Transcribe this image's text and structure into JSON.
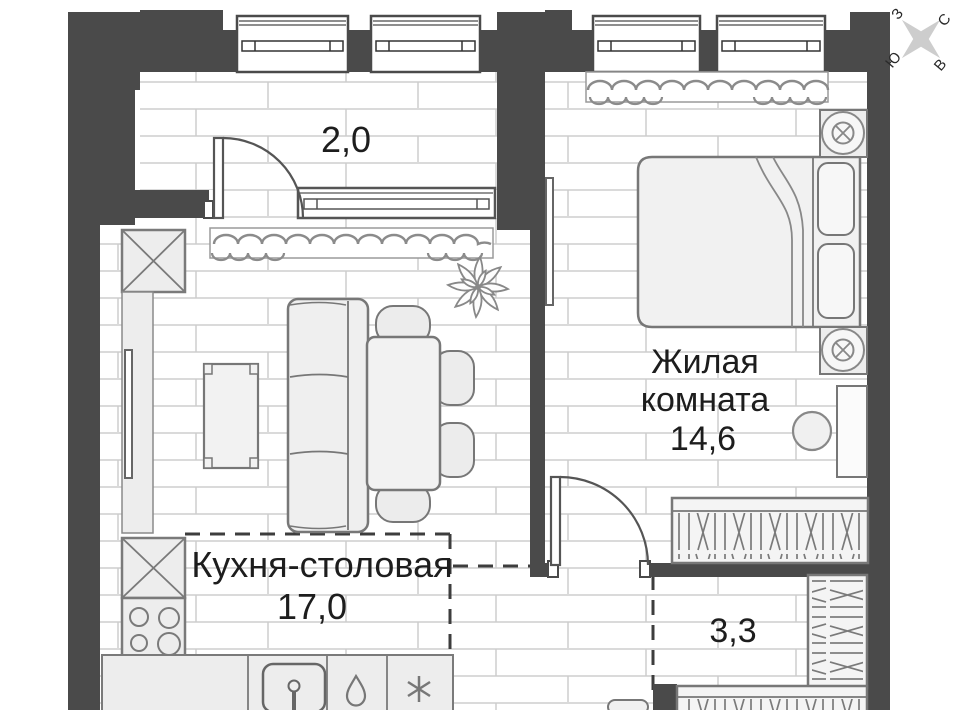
{
  "plan_title": "Apartment floor plan",
  "rooms": {
    "balcony": {
      "area": "2,0"
    },
    "living": {
      "name_line1": "Жилая",
      "name_line2": "комната",
      "area": "14,6"
    },
    "kitchen": {
      "name": "Кухня-столовая",
      "area": "17,0"
    },
    "hall": {
      "area": "3,3"
    }
  },
  "compass": {
    "north": "С",
    "south": "Ю",
    "west": "З",
    "east": "В"
  },
  "colors": {
    "wall": "#4a4a4a",
    "outline": "#777777",
    "furniture_fill": "#ededed",
    "floor_line": "#cdcdcd",
    "text": "#1d1d1d",
    "compass_star": "#cdcdcd"
  }
}
